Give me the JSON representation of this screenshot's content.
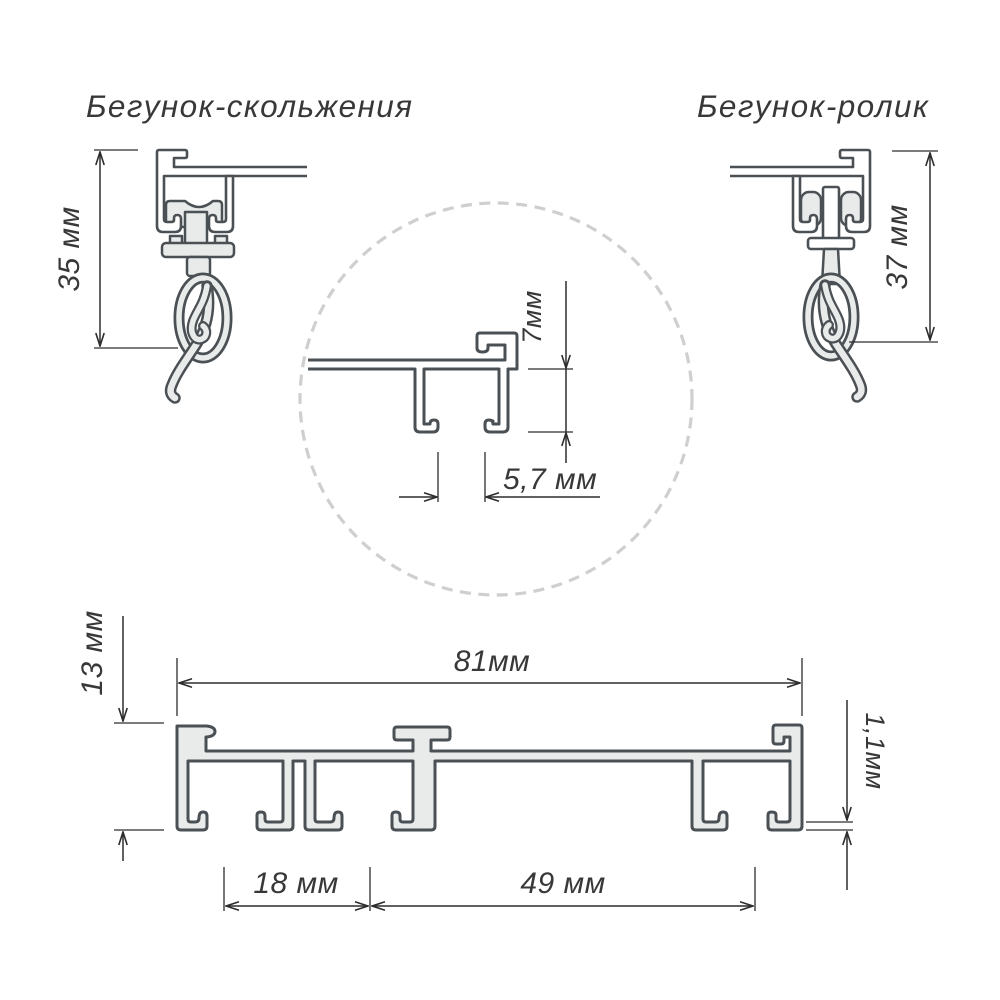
{
  "labels": {
    "title_slider": "Бегунок-скольжения",
    "title_roller": "Бегунок-ролик",
    "dim_slider_height": "35 мм",
    "dim_roller_height": "37 мм",
    "dim_groove_depth": "7мм",
    "dim_slot_width": "5,7 мм",
    "dim_profile_height": "13 мм",
    "dim_profile_width": "81мм",
    "dim_wall_thickness": "1,1мм",
    "dim_first_groove": "18 мм",
    "dim_second_groove": "49 мм"
  },
  "colors": {
    "background": "#ffffff",
    "drawing_outline": "#4b5055",
    "metal_fill": "#e9ebeb",
    "dimension_lines": "#2d2d2d",
    "text": "#383838",
    "detail_circle": "#cfcfcf"
  }
}
